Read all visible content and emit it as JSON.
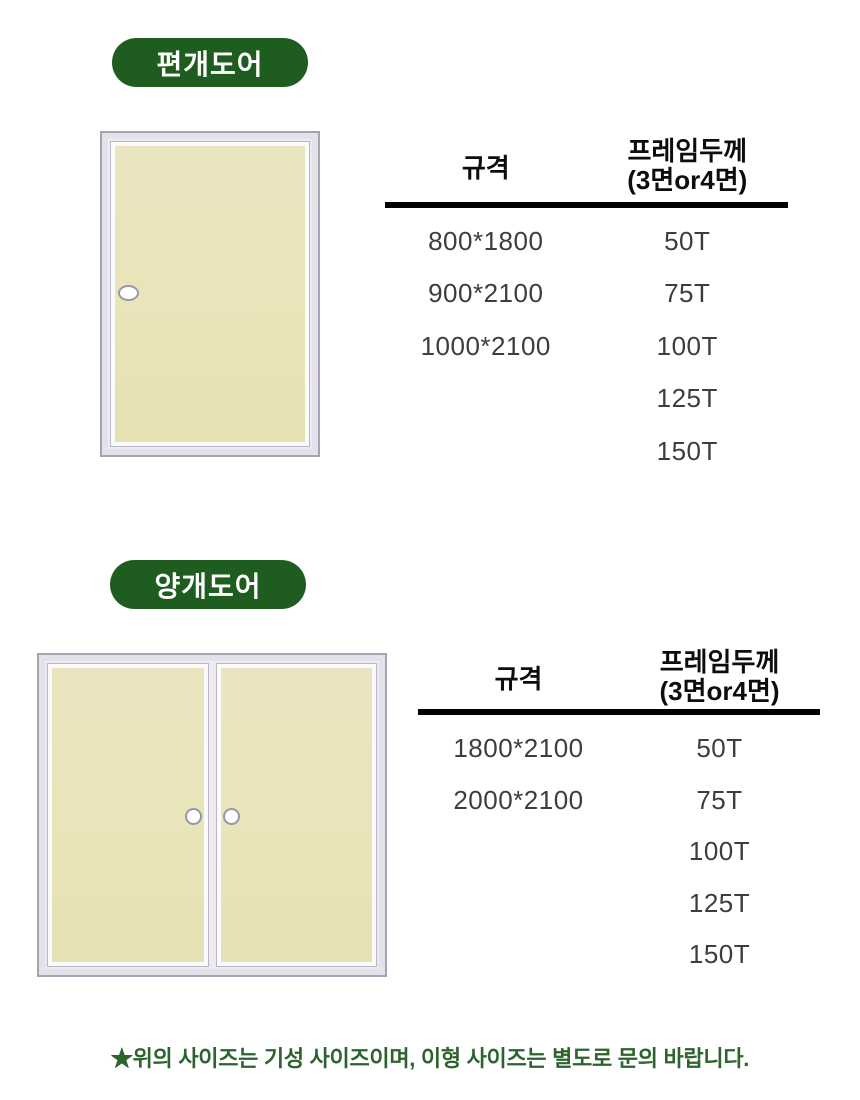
{
  "colors": {
    "badge_green": "#1e5c1f",
    "note_green": "#2d642d",
    "door_panel_cream": "#e9e4b9",
    "door_frame_gray": "#e3e1e9",
    "door_frame_border": "#a7a2b1",
    "header_rule_black": "#000000",
    "value_text": "#3d3d3d"
  },
  "sections": [
    {
      "badge": "편개도어",
      "door_type": "single-door-with-left-handle",
      "table": {
        "col1_header": "규격",
        "col2_header_line1": "프레임두께",
        "col2_header_line2": "(3면or4면)",
        "rows": [
          [
            "800*1800",
            "50T"
          ],
          [
            "900*2100",
            "75T"
          ],
          [
            "1000*2100",
            "100T"
          ],
          [
            "",
            "125T"
          ],
          [
            "",
            "150T"
          ]
        ]
      }
    },
    {
      "badge": "양개도어",
      "door_type": "double-door-with-center-handles",
      "table": {
        "col1_header": "규격",
        "col2_header_line1": "프레임두께",
        "col2_header_line2": "(3면or4면)",
        "rows": [
          [
            "1800*2100",
            "50T"
          ],
          [
            "2000*2100",
            "75T"
          ],
          [
            "",
            "100T"
          ],
          [
            "",
            "125T"
          ],
          [
            "",
            "150T"
          ]
        ]
      }
    }
  ],
  "note": "★위의 사이즈는 기성 사이즈이며, 이형 사이즈는 별도로 문의 바랍니다."
}
